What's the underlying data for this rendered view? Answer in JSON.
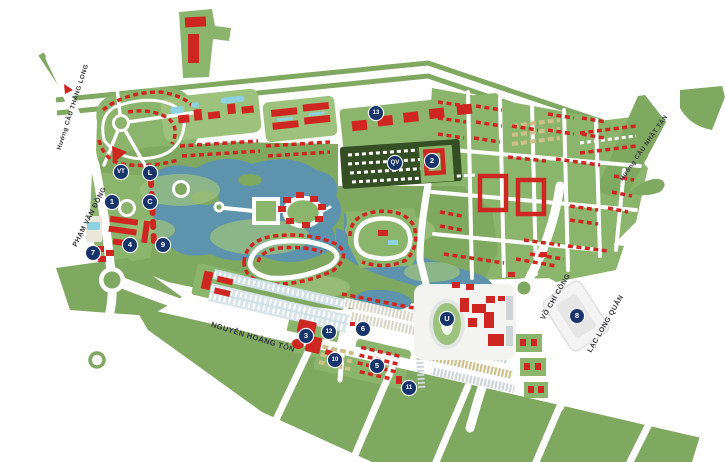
{
  "map": {
    "streets": [
      {
        "id": "huong-cau-thang-long",
        "label": "Hướng CẦU THĂNG LONG",
        "x": 73,
        "y": 107,
        "rotation": -72,
        "font_size": 6.3
      },
      {
        "id": "pham-van-dong",
        "label": "PHẠM VĂN ĐỒNG",
        "x": 90,
        "y": 217,
        "rotation": -63,
        "font_size": 7
      },
      {
        "id": "nguyen-hoang-ton",
        "label": "NGUYỄN HOÀNG TÔN",
        "x": 253,
        "y": 337,
        "rotation": 17,
        "font_size": 7.5
      },
      {
        "id": "vo-chi-cong",
        "label": "VÕ CHÍ CÔNG",
        "x": 556,
        "y": 297,
        "rotation": -60,
        "font_size": 7
      },
      {
        "id": "lac-long-quan",
        "label": "LẠC LONG QUÂN",
        "x": 606,
        "y": 324,
        "rotation": -60,
        "font_size": 7
      },
      {
        "id": "huong-cau-nhat-tan",
        "label": "Hướng CẦU NHẬT TÂN",
        "x": 644,
        "y": 148,
        "rotation": -55,
        "font_size": 6.3
      }
    ],
    "markers": [
      {
        "label": "1",
        "x": 112,
        "y": 202
      },
      {
        "label": "2",
        "x": 432,
        "y": 161
      },
      {
        "label": "3",
        "x": 306,
        "y": 336
      },
      {
        "label": "4",
        "x": 130,
        "y": 245
      },
      {
        "label": "5",
        "x": 377,
        "y": 366
      },
      {
        "label": "6",
        "x": 363,
        "y": 329
      },
      {
        "label": "7",
        "x": 93,
        "y": 253
      },
      {
        "label": "8",
        "x": 577,
        "y": 316
      },
      {
        "label": "9",
        "x": 163,
        "y": 245
      },
      {
        "label": "10",
        "x": 335,
        "y": 360
      },
      {
        "label": "11",
        "x": 409,
        "y": 388
      },
      {
        "label": "12",
        "x": 329,
        "y": 332
      },
      {
        "label": "13",
        "x": 376,
        "y": 113
      },
      {
        "label": "C",
        "x": 150,
        "y": 202
      },
      {
        "label": "L",
        "x": 150,
        "y": 173
      },
      {
        "label": "VT",
        "x": 121,
        "y": 172
      },
      {
        "label": "QV",
        "x": 395,
        "y": 163
      },
      {
        "label": "U",
        "x": 447,
        "y": 319
      }
    ],
    "colors": {
      "background": "#ffffff",
      "green_main": "#7fa861",
      "green_light": "#9cc27e",
      "green_block": "#8bb56d",
      "green_dark_trees": "#344f23",
      "water": "#5d93ac",
      "pool": "#8ed1e0",
      "building_red": "#ce2722",
      "building_gray": "#cdd5d8",
      "building_tan": "#cdc08b",
      "commercial_blue": "#cfe0e6",
      "road": "#ffffff",
      "marker_bg": "#17356b",
      "marker_text": "#ffffff",
      "street_label": "#34343c"
    }
  }
}
